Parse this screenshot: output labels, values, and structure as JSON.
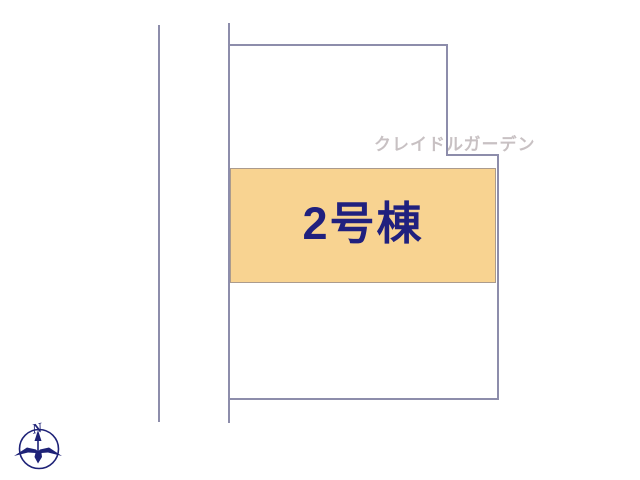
{
  "watermark": {
    "text": "クレイドルガーデン"
  },
  "building": {
    "label": "2号棟"
  },
  "compass": {
    "letter": "N"
  },
  "colors": {
    "boundary_line": "#8d8dab",
    "watermark_text": "#c8c1c3",
    "building_fill": "#f8d391",
    "building_border": "#ab9b8d",
    "building_label": "#20207e",
    "compass": "#1e2277"
  }
}
